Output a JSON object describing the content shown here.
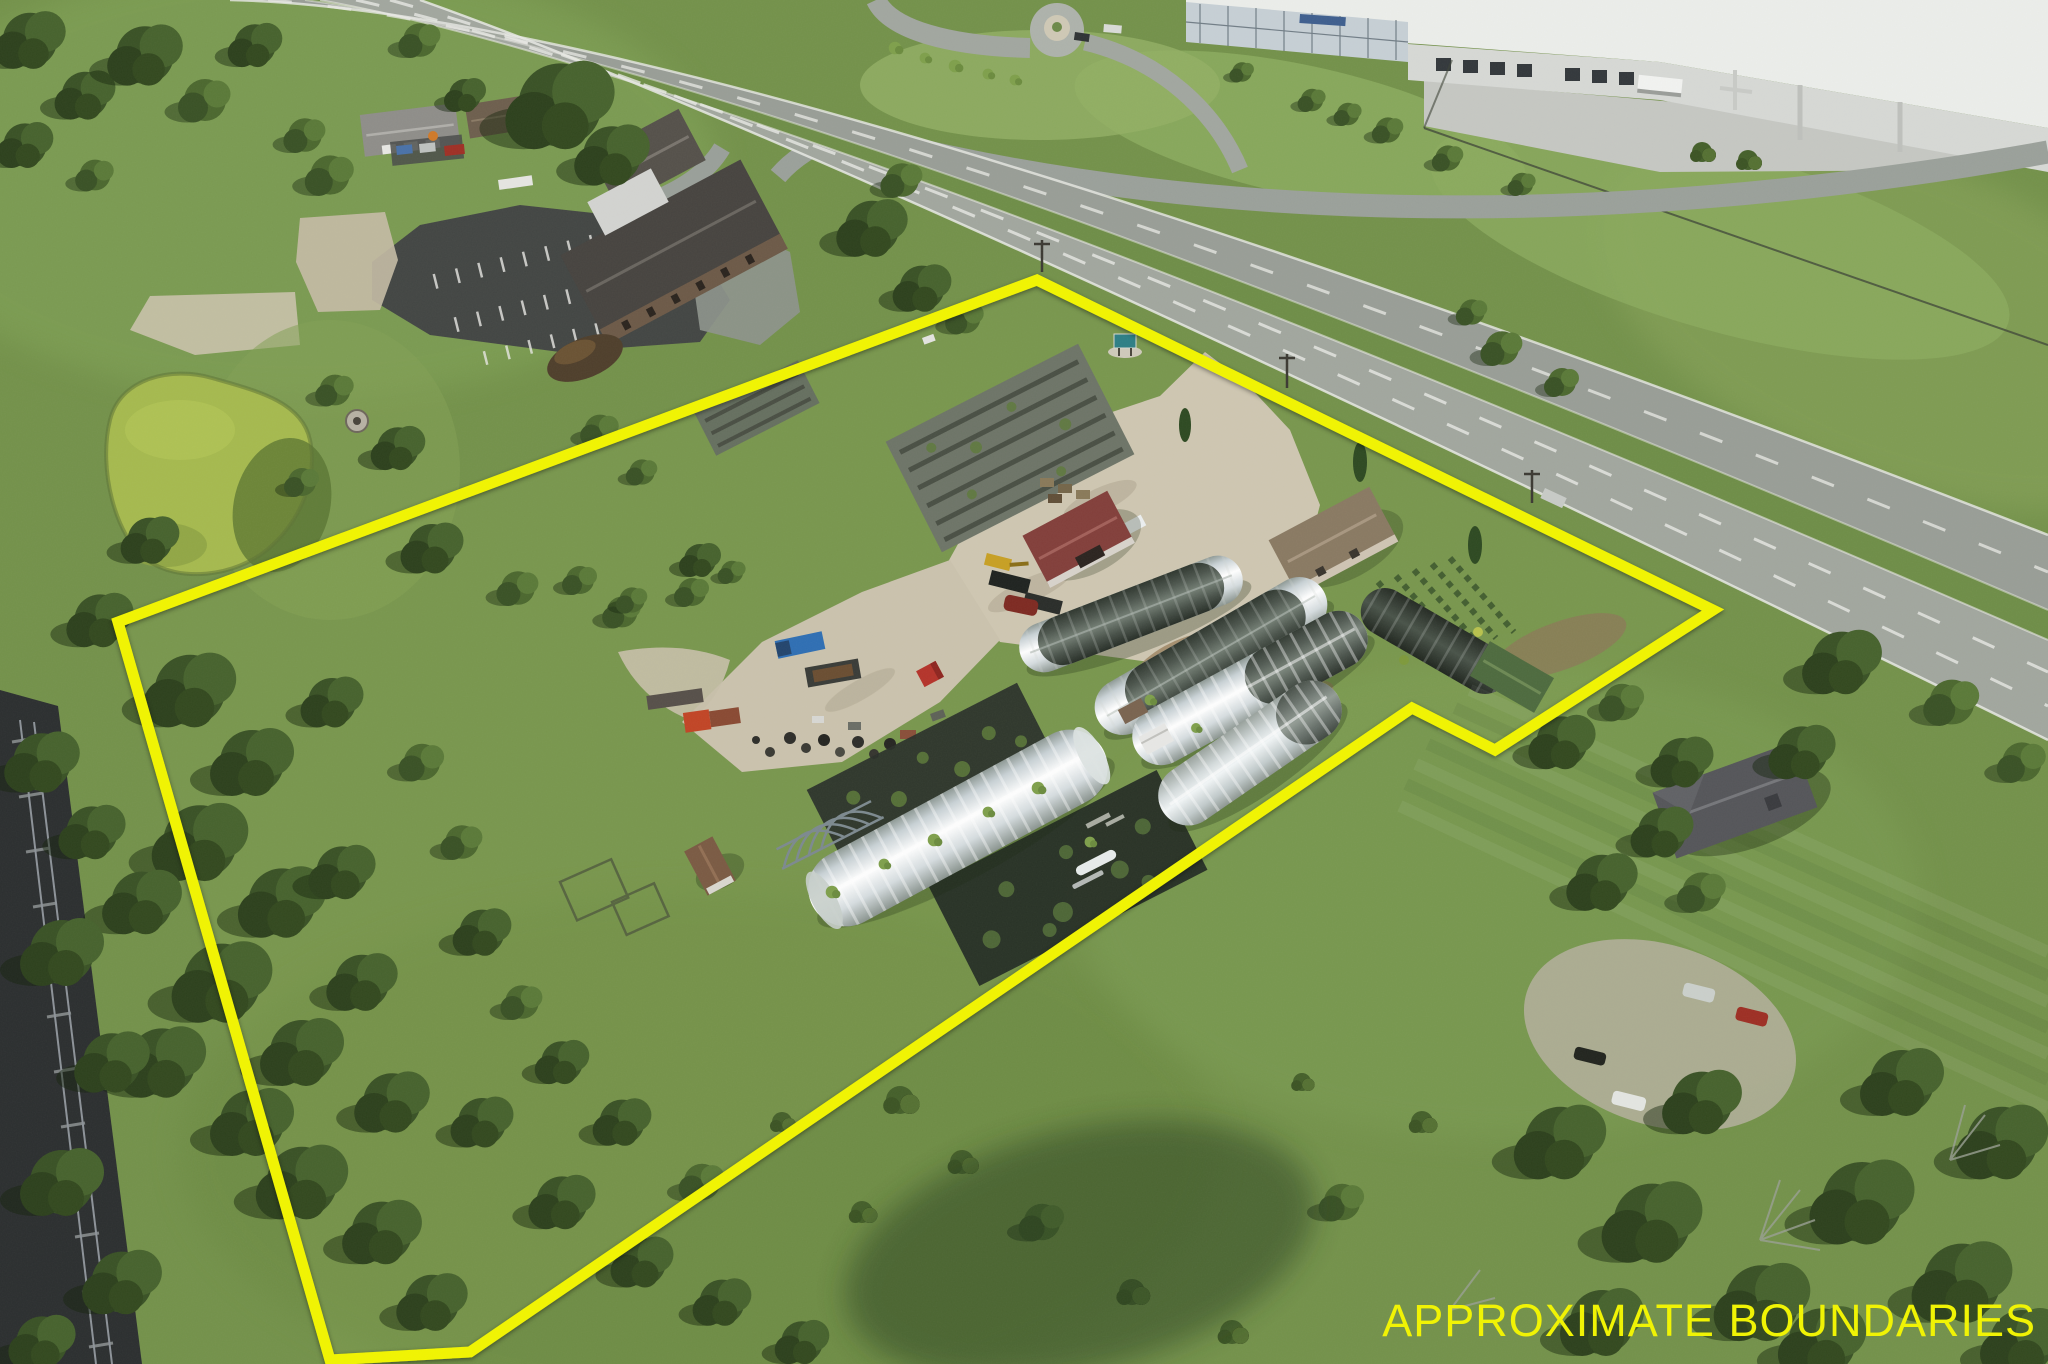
{
  "annotation": {
    "label": "APPROXIMATE BOUNDARIES",
    "color": "#F2F500"
  },
  "boundary": {
    "color": "#F2F500",
    "stroke_width": 11,
    "points": "118,622 1037,280 1713,610 1495,750 1412,708 470,1352 330,1360"
  },
  "scene": {
    "type": "aerial-drone-photo",
    "palette": {
      "grass": "#74924B",
      "grass_light": "#8FAE5F",
      "trees_dark": "#31451F",
      "road_gray": "#9BA19B",
      "gravel": "#CFC7B2",
      "pond_algae": "#A6BA4F",
      "greenhouse_white": "#EDF1F3",
      "greenhouse_mesh": "#59635B",
      "warehouse_white": "#ECEEEB",
      "parking_asphalt": "#434644",
      "barn_roof_red": "#833F3B",
      "railroad_dark": "#2C2F30"
    },
    "features": [
      "boundary-overlay",
      "highway",
      "frontage-road",
      "railroad-tracks",
      "algae-pond",
      "fire-pit",
      "warehouse-building",
      "loading-docks",
      "roundabout",
      "church-building",
      "striped-parking-lot",
      "houses",
      "greenhouses",
      "hoop-frames",
      "shade-tunnel",
      "garden-beds",
      "black-plastic-plots",
      "gravel-driveway",
      "barn",
      "farmhouse",
      "sheds",
      "nursery-rows",
      "vehicles",
      "junk-piles",
      "tree-clusters",
      "meadow",
      "residential-house",
      "parked-cars"
    ]
  }
}
